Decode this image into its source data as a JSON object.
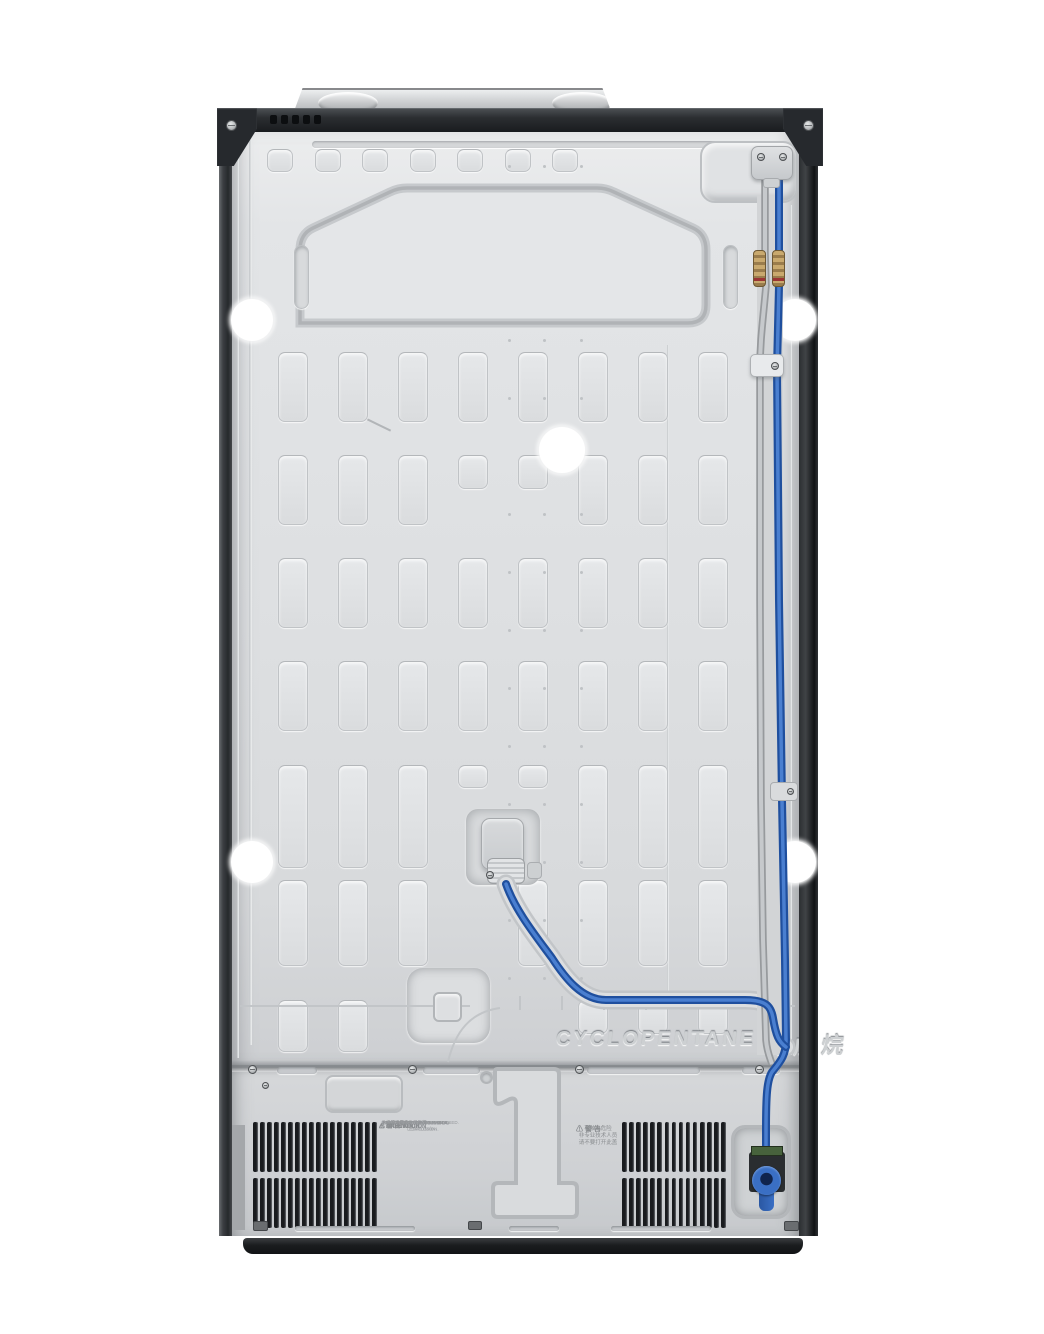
{
  "embossed": {
    "material_text": "CYCLOPENTANE",
    "material_text_cn": "环戊烷"
  },
  "warning_labels": {
    "caution_block": [
      {
        "header": "⚠ 警 告",
        "lines": [
          "本机使用可燃性发泡剂",
          "维修须由专业人员进行"
        ]
      },
      {
        "header": "⚠ CAUTION",
        "lines": [
          "RISK OF FIRE OR EXPLOSION.",
          "FLAMMABLE REFRIGERANT USED."
        ]
      },
      {
        "header": "⚠ PRECAUCIÓN",
        "lines": [
          "RIESGO DE INCENDIO O EXPLOSIÓN.",
          "REFRIGERANTE INFLAMABLE."
        ]
      },
      {
        "header": "⚠ ATTENTION",
        "lines": [
          "RISQUE D'INCENDIE OU D'EXPLOSION.",
          "FRIGORIGÈNE INFLAMMABLE."
        ]
      }
    ],
    "shock_block": {
      "header": "⚠ 警 告",
      "lines": [
        "有触电危险",
        "非专业技术人员",
        "请不要打开此盖"
      ]
    }
  },
  "colors": {
    "panel_silver": "#dcdee0",
    "water_line_blue": "#1f4f9e",
    "water_line_highlight": "#4a7fd0",
    "gray_tube": "#b0b3b6",
    "brass_fitting": "#b2955f",
    "valve_blue": "#3a6fc4",
    "pcb_green": "#47623c",
    "vent_black": "#191b1e",
    "base_black": "#17191b"
  }
}
